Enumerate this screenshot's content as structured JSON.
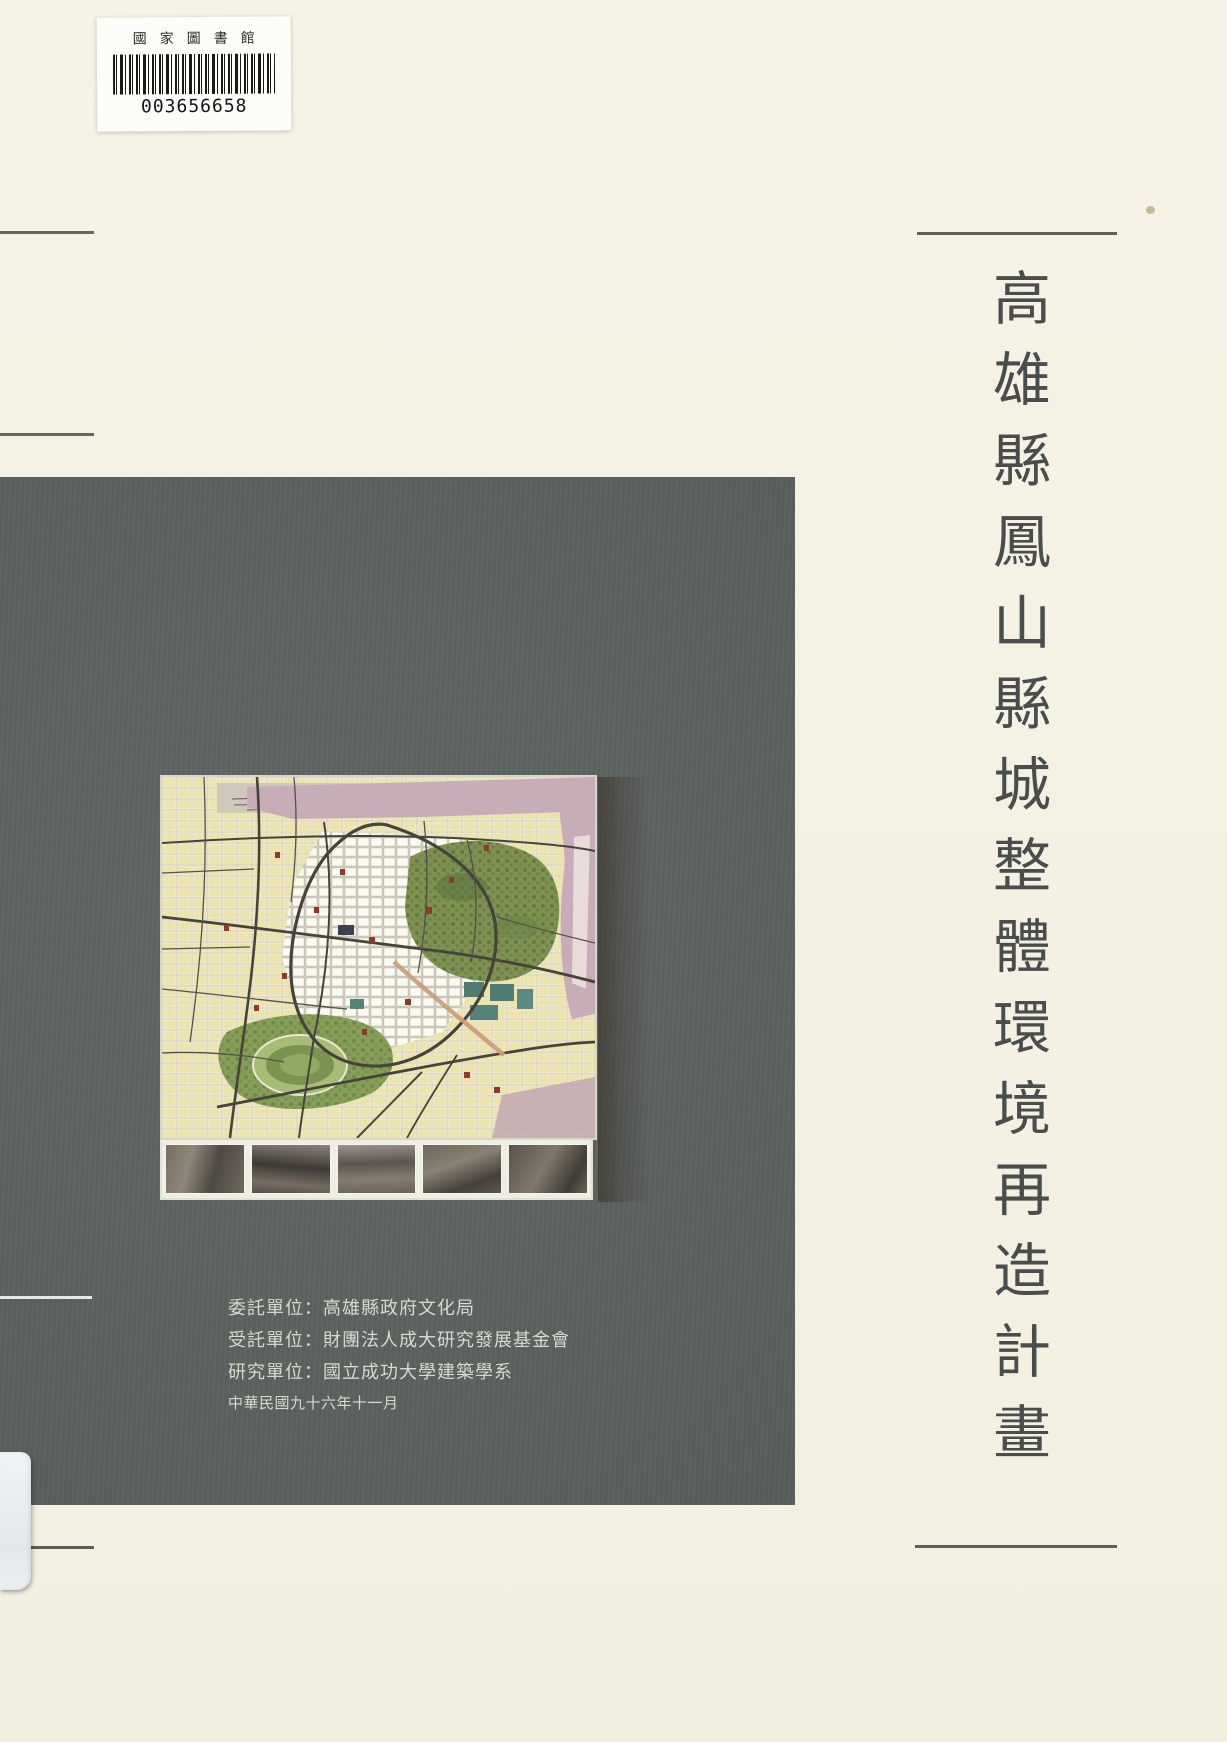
{
  "cover": {
    "paper_color": "#f4f1e2",
    "panel_color": "#5a615e"
  },
  "barcode_label": {
    "library_name": "國家圖書館",
    "number": "003656658"
  },
  "title": {
    "text": "高雄縣鳳山縣城整體環境再造計畫",
    "color": "#494d4b"
  },
  "credits": {
    "color": "#dad9cd",
    "lines": [
      "委託單位：高雄縣政府文化局",
      "受託單位：財團法人成大研究發展基金會",
      "研究單位：國立成功大學建築學系",
      "中華民國九十六年十一月"
    ]
  },
  "map": {
    "icon": "city-plan-map-image",
    "photo_count": "5"
  }
}
